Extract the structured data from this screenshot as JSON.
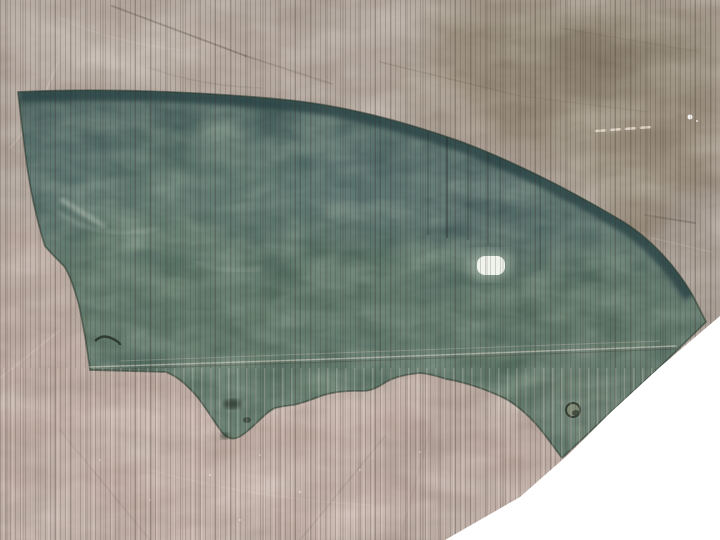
{
  "meta": {
    "type": "photograph",
    "subject": "Green-tinted automotive front door window glass lying flat on a crinkled tarpaulin sheet",
    "text_visible": "none"
  },
  "scene": {
    "background": "woven tarpaulin with vertical weave striations and crinkle creases",
    "foreground": "curved door glass with wavy lower edge and mounting hole",
    "corner": "white diagonal cutout covering the bottom-right corner of the photo",
    "details": [
      "bright specular highlight spot on the glass",
      "round mounting hole near the glass lower edge",
      "horizontal fold line running across tarp and glass",
      "dark crease lines on the tarp",
      "white dashed scuff on upper-right tarp"
    ]
  },
  "colors": {
    "tarp_mauve": "#a89a91",
    "tarp_mauve_light": "#cfc2ba",
    "tarp_brown": "#7c705a",
    "tarp_brown_dark": "#6b604a",
    "tarp_gray_sliver": "#9e9289",
    "tarp_pink": "#bea69e",
    "tarp_pink_light": "#cdb6ae",
    "glass_top": "#2e4749",
    "glass_upper": "#44605e",
    "glass_mid": "#4a6455",
    "glass_low": "#57705c",
    "glass_band": "#2b4547",
    "glass_edge": "#2a3a30",
    "highlight_white": "#f3f7ef",
    "fold_light": "#e3dccf",
    "hole_ring": "#7e8a76",
    "hole_dark": "#39463a",
    "cutout_white": "#ffffff"
  }
}
